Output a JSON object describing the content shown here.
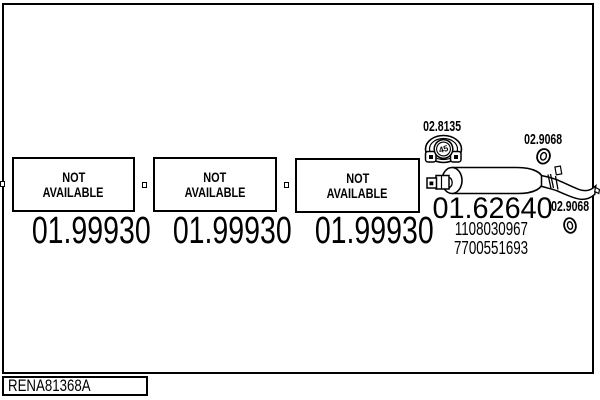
{
  "colors": {
    "line": "#000000",
    "background": "#ffffff"
  },
  "footer": {
    "code": "RENA81368A"
  },
  "sections": {
    "boxes": [
      {
        "status_line1": "NOT",
        "status_line2": "AVAILABLE",
        "part_number": "01.99930"
      },
      {
        "status_line1": "NOT",
        "status_line2": "AVAILABLE",
        "part_number": "01.99930"
      },
      {
        "status_line1": "NOT",
        "status_line2": "AVAILABLE",
        "part_number": "01.99930"
      }
    ],
    "gasket": {
      "part_number": "02.8135",
      "marking": "45"
    },
    "ring_upper": {
      "part_number": "02.9068"
    },
    "ring_lower": {
      "part_number": "02.9068"
    },
    "muffler": {
      "part_number": "01.62640",
      "oe_number_1": "1108030967",
      "oe_number_2": "7700551693"
    }
  }
}
